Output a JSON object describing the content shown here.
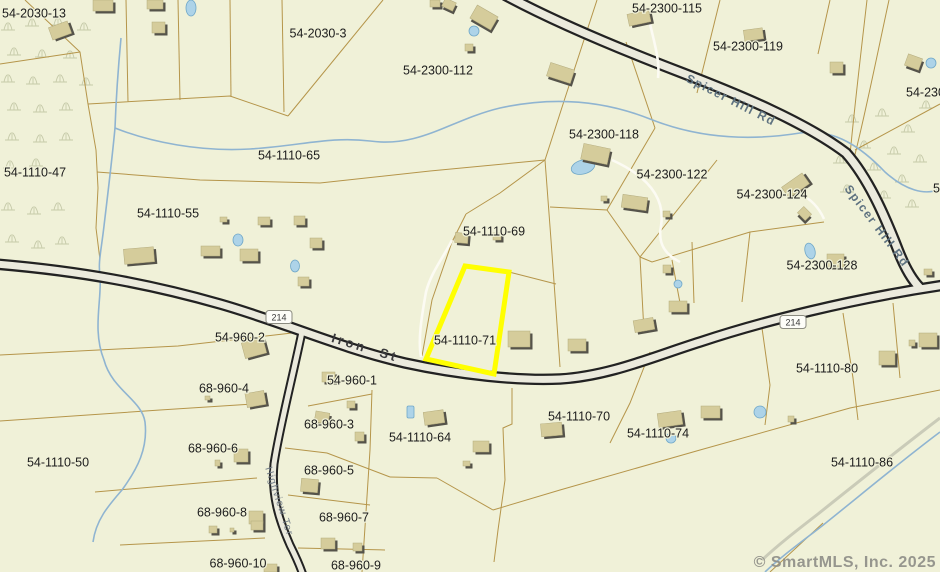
{
  "map": {
    "watermark": "© SmartMLS, Inc. 2025",
    "highlight": {
      "parcel_id": "54-1110-71",
      "color": "#ffff00"
    },
    "colors": {
      "background": "#f0f1d8",
      "parcel_line": "#b5954a",
      "road_casing": "#222222",
      "road_fill": "#ebeadd",
      "water": "#8fb4d1",
      "pond_fill": "#add3e8",
      "building": "#d5cc9b",
      "building_shadow": "#55534a",
      "label": "#1c1c1c",
      "route_label": "#5e7280",
      "minor_road_label": "#76808a"
    },
    "parcel_labels": [
      {
        "text": "54-2030-13",
        "x": 34,
        "y": 13
      },
      {
        "text": "54-2030-3",
        "x": 318,
        "y": 33
      },
      {
        "text": "54-2300-112",
        "x": 438,
        "y": 70
      },
      {
        "text": "54-2300-115",
        "x": 667,
        "y": 8
      },
      {
        "text": "54-2300-119",
        "x": 748,
        "y": 46
      },
      {
        "text": "54-230",
        "x": 906,
        "y": 92,
        "anchor": "start"
      },
      {
        "text": "54-2300-118",
        "x": 604,
        "y": 134
      },
      {
        "text": "54-1110-65",
        "x": 289,
        "y": 155
      },
      {
        "text": "54-1110-47",
        "x": 35,
        "y": 172
      },
      {
        "text": "54-1110-55",
        "x": 168,
        "y": 213
      },
      {
        "text": "54-2300-122",
        "x": 672,
        "y": 174
      },
      {
        "text": "54-2300-124",
        "x": 772,
        "y": 194
      },
      {
        "text": "5",
        "x": 933,
        "y": 188,
        "anchor": "start"
      },
      {
        "text": "54-1110-69",
        "x": 494,
        "y": 231
      },
      {
        "text": "54-2300-128",
        "x": 822,
        "y": 265
      },
      {
        "text": "54-1110-71",
        "x": 465,
        "y": 340
      },
      {
        "text": "54-960-2",
        "x": 240,
        "y": 337
      },
      {
        "text": "54-960-1",
        "x": 352,
        "y": 380
      },
      {
        "text": "68-960-4",
        "x": 224,
        "y": 388
      },
      {
        "text": "68-960-3",
        "x": 329,
        "y": 424
      },
      {
        "text": "54-1110-64",
        "x": 420,
        "y": 437
      },
      {
        "text": "54-1110-70",
        "x": 579,
        "y": 416
      },
      {
        "text": "68-960-6",
        "x": 213,
        "y": 448
      },
      {
        "text": "54-1110-50",
        "x": 58,
        "y": 462
      },
      {
        "text": "68-960-5",
        "x": 329,
        "y": 470
      },
      {
        "text": "68-960-8",
        "x": 222,
        "y": 512
      },
      {
        "text": "68-960-7",
        "x": 344,
        "y": 517
      },
      {
        "text": "54-1110-74",
        "x": 658,
        "y": 433
      },
      {
        "text": "54-1110-80",
        "x": 827,
        "y": 368
      },
      {
        "text": "54-1110-86",
        "x": 862,
        "y": 462
      },
      {
        "text": "68-960-10",
        "x": 238,
        "y": 563
      },
      {
        "text": "68-960-9",
        "x": 356,
        "y": 565
      }
    ],
    "road_labels": [
      {
        "text": "Iron St",
        "x": 365,
        "y": 348,
        "angle": 17,
        "style": "major"
      },
      {
        "text": "Spicer Hill Rd",
        "x": 731,
        "y": 100,
        "angle": 27,
        "style": "route"
      },
      {
        "text": "Spicer Hill Rd",
        "x": 877,
        "y": 226,
        "angle": 53,
        "style": "route"
      },
      {
        "text": "Highview Ter",
        "x": 280,
        "y": 501,
        "angle": 72,
        "style": "minor"
      }
    ],
    "route_shields": [
      {
        "text": "214",
        "x": 279,
        "y": 317
      },
      {
        "text": "214",
        "x": 793,
        "y": 322
      }
    ]
  }
}
